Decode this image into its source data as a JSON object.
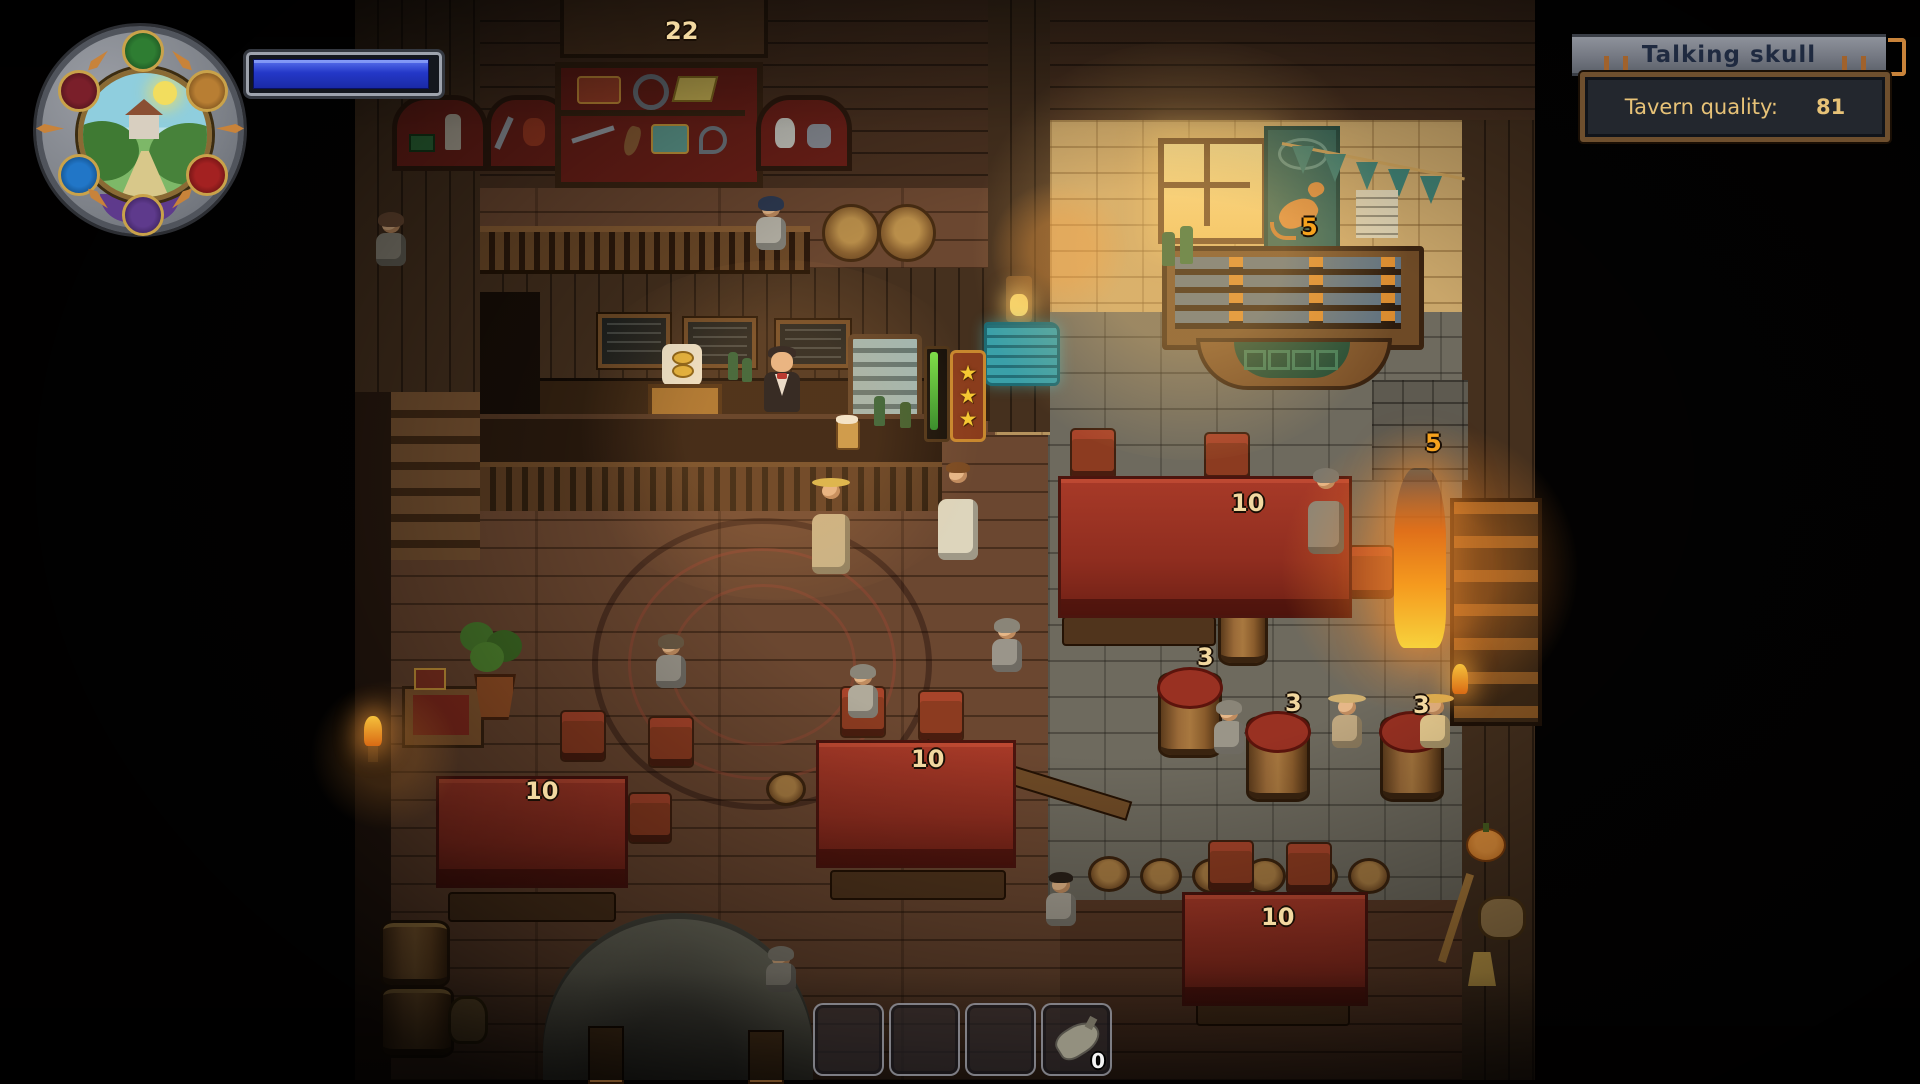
{
  "top_right_panel": {
    "title": "Talking skull",
    "quality_label": "Tavern quality:",
    "quality_value": "81"
  },
  "badges": [
    {
      "location": "entrance-sign",
      "value": "22"
    },
    {
      "location": "left-table",
      "value": "10"
    },
    {
      "location": "center-table",
      "value": "10"
    },
    {
      "location": "large-table",
      "value": "10"
    },
    {
      "location": "bottom-right-table",
      "value": "10"
    },
    {
      "location": "barrel-table-left",
      "value": "3"
    },
    {
      "location": "barrel-table-middle",
      "value": "3"
    },
    {
      "location": "barrel-table-right",
      "value": "3"
    },
    {
      "location": "rat-banner",
      "value": "5"
    },
    {
      "location": "right-wall",
      "value": "5"
    }
  ],
  "hotbar": {
    "slots": [
      {
        "item": "",
        "count": ""
      },
      {
        "item": "",
        "count": ""
      },
      {
        "item": "",
        "count": ""
      },
      {
        "item": "waterskin",
        "count": "0"
      }
    ]
  },
  "bar": {
    "star_rating": "★★★"
  },
  "colors": {
    "badge_text_tan": "#f2d8a0",
    "badge_text_orange": "#f6a21d",
    "panel_text_gold": "#e7c277",
    "banner_title": "#1f2a40",
    "progress_blue": "#2f43d6"
  }
}
